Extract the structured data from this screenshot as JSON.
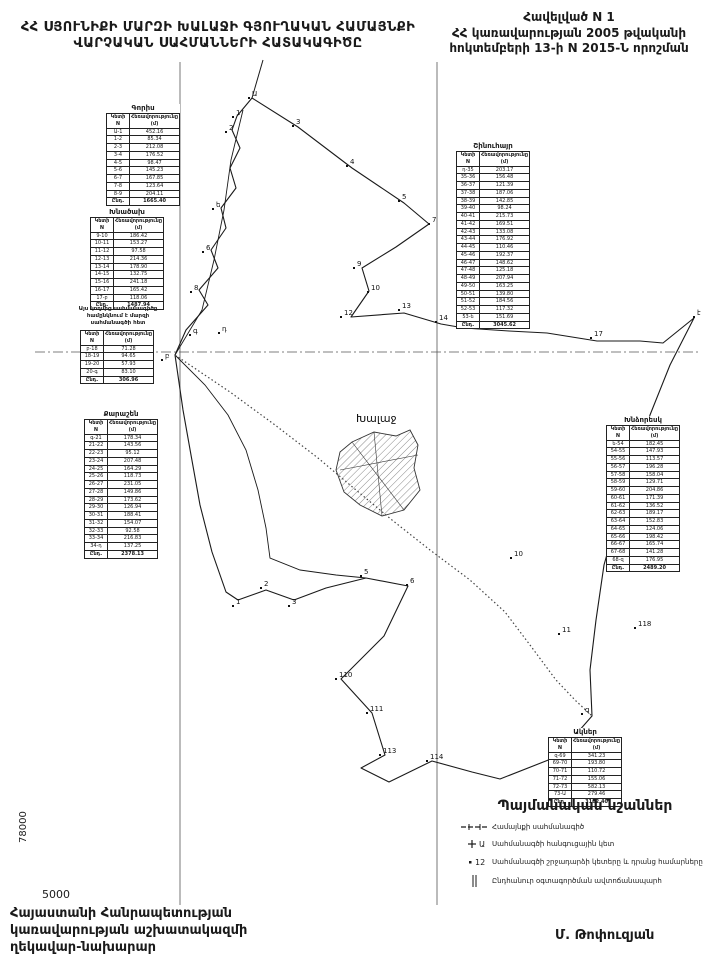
{
  "header": {
    "title_line1": "ՀՀ ՍՅՈՒՆԻՔԻ ՄԱՐԶԻ ԽԱԼԱՋԻ ԳՅՈՒՂԱԿԱՆ ՀԱՄԱՅՆՔԻ",
    "title_line2": "ՎԱՐՉԱԿԱՆ  ՍԱՀՄԱՆՆԵՐԻ  ՀԱՏԱԿԱԳԻԾԸ",
    "annex_line1": "Հավելված  N 1",
    "annex_line2": "ՀՀ կառավարության 2005 թվականի",
    "annex_line3": "հոկտեմբերի 13-ի N 2015-Ն որոշման"
  },
  "map": {
    "settlement_label": "Խալաջ",
    "grid_label_vertical": "78000",
    "grid_label_horizontal": "5000",
    "point_labels": [
      {
        "t": "Ա",
        "x": 252,
        "y": 96
      },
      {
        "t": "1",
        "x": 236,
        "y": 115
      },
      {
        "t": "2",
        "x": 229,
        "y": 130
      },
      {
        "t": "3",
        "x": 296,
        "y": 124
      },
      {
        "t": "4",
        "x": 350,
        "y": 164
      },
      {
        "t": "5",
        "x": 402,
        "y": 199
      },
      {
        "t": "7",
        "x": 432,
        "y": 222
      },
      {
        "t": "9",
        "x": 357,
        "y": 266
      },
      {
        "t": "10",
        "x": 371,
        "y": 290
      },
      {
        "t": "ե",
        "x": 216,
        "y": 207
      },
      {
        "t": "6",
        "x": 206,
        "y": 250
      },
      {
        "t": "8",
        "x": 194,
        "y": 290
      },
      {
        "t": "12",
        "x": 344,
        "y": 315
      },
      {
        "t": "13",
        "x": 402,
        "y": 308
      },
      {
        "t": "14",
        "x": 439,
        "y": 320
      },
      {
        "t": "15",
        "x": 462,
        "y": 323
      },
      {
        "t": "16",
        "x": 507,
        "y": 326
      },
      {
        "t": "17",
        "x": 594,
        "y": 336
      },
      {
        "t": "է",
        "x": 697,
        "y": 315
      },
      {
        "t": "բ",
        "x": 165,
        "y": 358
      },
      {
        "t": "գ",
        "x": 193,
        "y": 333
      },
      {
        "t": "դ",
        "x": 222,
        "y": 331
      },
      {
        "t": "1",
        "x": 236,
        "y": 604
      },
      {
        "t": "2",
        "x": 264,
        "y": 586
      },
      {
        "t": "3",
        "x": 292,
        "y": 604
      },
      {
        "t": "5",
        "x": 364,
        "y": 574
      },
      {
        "t": "6",
        "x": 410,
        "y": 583
      },
      {
        "t": "10",
        "x": 514,
        "y": 556
      },
      {
        "t": "11",
        "x": 562,
        "y": 632
      },
      {
        "t": "110",
        "x": 339,
        "y": 677
      },
      {
        "t": "111",
        "x": 370,
        "y": 711
      },
      {
        "t": "113",
        "x": 383,
        "y": 753
      },
      {
        "t": "114",
        "x": 430,
        "y": 759
      },
      {
        "t": "118",
        "x": 638,
        "y": 626
      },
      {
        "t": "զ",
        "x": 585,
        "y": 712
      }
    ]
  },
  "tables": [
    {
      "title": "Գորիս",
      "col1": "Կետի N",
      "col2": "Հեռավորությունը (մ)",
      "rows": [
        [
          "Ա-1",
          "452.16"
        ],
        [
          "1-2",
          "85.34"
        ],
        [
          "2-3",
          "212.08"
        ],
        [
          "3-4",
          "176.52"
        ],
        [
          "4-5",
          "98.47"
        ],
        [
          "5-6",
          "145.23"
        ],
        [
          "6-7",
          "167.85"
        ],
        [
          "7-8",
          "123.64"
        ],
        [
          "8-9",
          "204.11"
        ]
      ],
      "total_label": "Ընդ.",
      "total": "1665.40"
    },
    {
      "title": "Խնածախ",
      "col1": "Կետի N",
      "col2": "Հեռավորությունը (մ)",
      "rows": [
        [
          "9-10",
          "186.42"
        ],
        [
          "10-11",
          "153.27"
        ],
        [
          "11-12",
          "97.58"
        ],
        [
          "12-13",
          "214.36"
        ],
        [
          "13-14",
          "178.90"
        ],
        [
          "14-15",
          "132.75"
        ],
        [
          "15-16",
          "241.18"
        ],
        [
          "16-17",
          "165.42"
        ],
        [
          "17-բ",
          "118.06"
        ]
      ],
      "total_label": "Ընդ.",
      "total": "1487.94"
    },
    {
      "title": "",
      "col1": "Կետի N",
      "col2": "Հեռավորությունը (մ)",
      "rows": [
        [
          "բ-18",
          "71.28"
        ],
        [
          "18-19",
          "94.65"
        ],
        [
          "19-20",
          "57.93"
        ],
        [
          "20-գ",
          "83.10"
        ]
      ],
      "total_label": "Ընդ.",
      "total": "306.96"
    },
    {
      "title": "Քարաշեն",
      "col1": "Կետի N",
      "col2": "Հեռավորությունը (մ)",
      "rows": [
        [
          "գ-21",
          "178.34"
        ],
        [
          "21-22",
          "143.56"
        ],
        [
          "22-23",
          "95.12"
        ],
        [
          "23-24",
          "207.48"
        ],
        [
          "24-25",
          "164.29"
        ],
        [
          "25-26",
          "118.73"
        ],
        [
          "26-27",
          "231.05"
        ],
        [
          "27-28",
          "149.86"
        ],
        [
          "28-29",
          "173.62"
        ],
        [
          "29-30",
          "126.94"
        ],
        [
          "30-31",
          "188.41"
        ],
        [
          "31-32",
          "154.07"
        ],
        [
          "32-33",
          "92.58"
        ],
        [
          "33-34",
          "216.83"
        ],
        [
          "34-դ",
          "137.25"
        ]
      ],
      "total_label": "Ընդ.",
      "total": "2378.13"
    },
    {
      "title": "Շինուհայր",
      "col1": "Կետի N",
      "col2": "Հեռավորությունը (մ)",
      "rows": [
        [
          "դ-35",
          "203.17"
        ],
        [
          "35-36",
          "156.48"
        ],
        [
          "36-37",
          "121.39"
        ],
        [
          "37-38",
          "187.06"
        ],
        [
          "38-39",
          "142.85"
        ],
        [
          "39-40",
          "98.24"
        ],
        [
          "40-41",
          "215.73"
        ],
        [
          "41-42",
          "169.51"
        ],
        [
          "42-43",
          "133.08"
        ],
        [
          "43-44",
          "176.92"
        ],
        [
          "44-45",
          "110.46"
        ],
        [
          "45-46",
          "192.37"
        ],
        [
          "46-47",
          "148.62"
        ],
        [
          "47-48",
          "125.18"
        ],
        [
          "48-49",
          "207.94"
        ],
        [
          "49-50",
          "163.25"
        ],
        [
          "50-51",
          "139.80"
        ],
        [
          "51-52",
          "184.56"
        ],
        [
          "52-53",
          "117.32"
        ],
        [
          "53-ե",
          "151.69"
        ]
      ],
      "total_label": "Ընդ.",
      "total": "3045.62"
    },
    {
      "title": "Խնձորեսկ",
      "col1": "Կետի N",
      "col2": "Հեռավորությունը (մ)",
      "rows": [
        [
          "ե-54",
          "182.45"
        ],
        [
          "54-55",
          "147.93"
        ],
        [
          "55-56",
          "113.57"
        ],
        [
          "56-57",
          "196.28"
        ],
        [
          "57-58",
          "158.04"
        ],
        [
          "58-59",
          "129.71"
        ],
        [
          "59-60",
          "204.86"
        ],
        [
          "60-61",
          "171.39"
        ],
        [
          "61-62",
          "136.52"
        ],
        [
          "62-63",
          "189.17"
        ],
        [
          "63-64",
          "152.83"
        ],
        [
          "64-65",
          "124.06"
        ],
        [
          "65-66",
          "198.42"
        ],
        [
          "66-67",
          "165.74"
        ],
        [
          "67-68",
          "141.28"
        ],
        [
          "68-զ",
          "176.95"
        ]
      ],
      "total_label": "Ընդ.",
      "total": "2489.20"
    },
    {
      "title": "Ակներ",
      "col1": "Կետի N",
      "col2": "Հեռավորությունը (մ)",
      "rows": [
        [
          "զ-69",
          "341.23"
        ],
        [
          "69-70",
          "193.80"
        ],
        [
          "70-71",
          "110.72"
        ],
        [
          "71-72",
          "155.06"
        ],
        [
          "72-73",
          "582.13"
        ],
        [
          "73-Ա",
          "279.46"
        ]
      ],
      "total_label": "Ընդ.",
      "total": "3162.40"
    }
  ],
  "note": {
    "line1": "Այս կողմից սահմանագիծը",
    "line2": "համընկնում է մարզի",
    "line3": "սահմանագծի հետ"
  },
  "legend": {
    "title": "Պայմանական նշաններ",
    "items": [
      {
        "icon": "boundary-line-symbol",
        "label": "Համայնքի սահմանագիծ"
      },
      {
        "icon": "junction-point-symbol",
        "label": "Սահմանագծի հանգուցային կետ"
      },
      {
        "icon": "turning-point-symbol",
        "label": "Սահմանագծի շրջադարձի կետերը և դրանց համարները"
      },
      {
        "icon": "road-symbol",
        "label": "Ընդհանուր օգտագործման ավտոճանապարհ"
      }
    ]
  },
  "footer": {
    "left_line1": "Հայաստանի Հանրապետության",
    "left_line2": "կառավարության աշխատակազմի",
    "left_line3": "ղեկավար-նախարար",
    "signature": "Մ. Թոփուզյան"
  }
}
